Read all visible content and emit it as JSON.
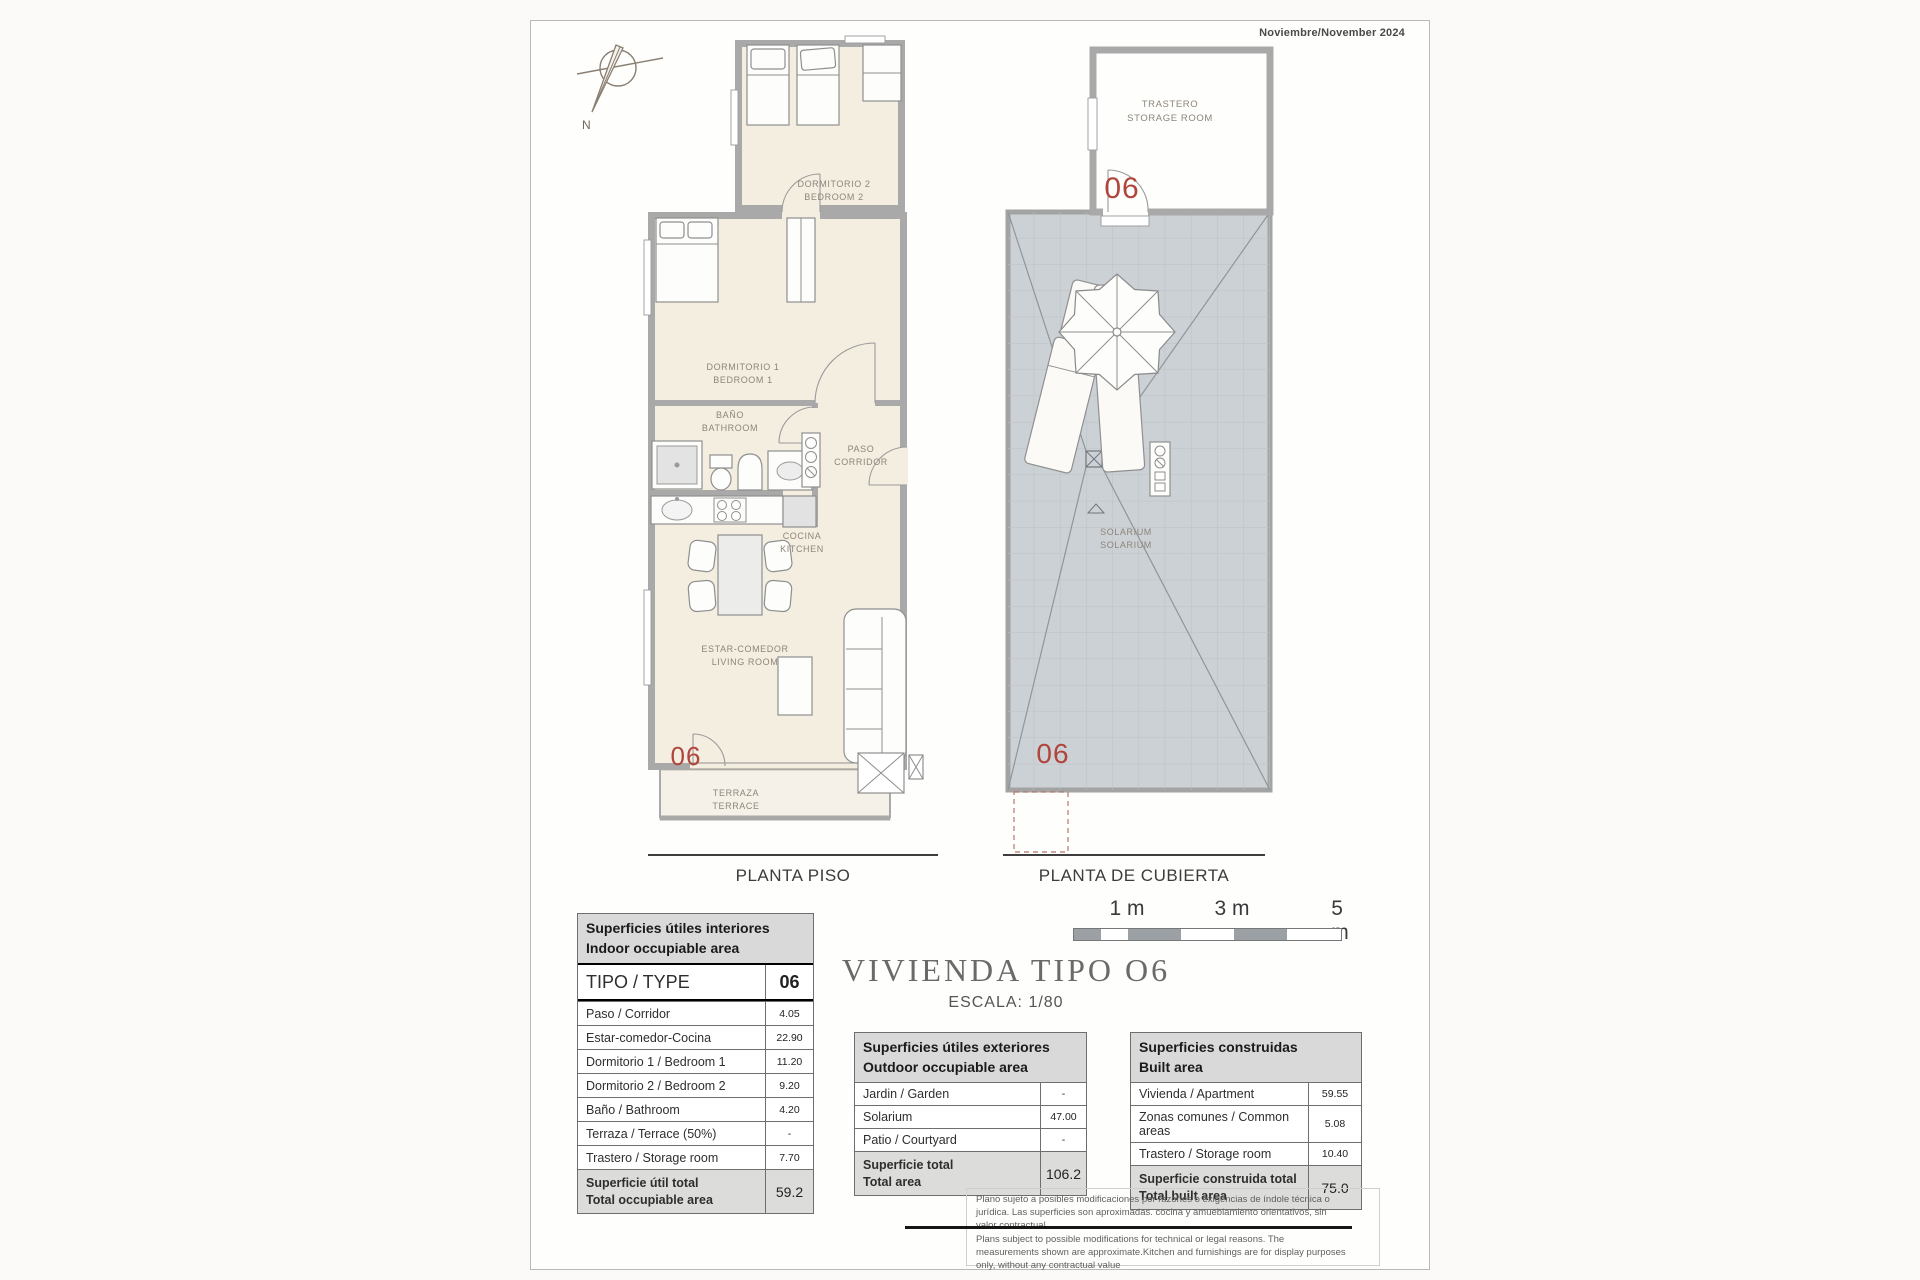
{
  "page": {
    "date": "Noviembre/November 2024"
  },
  "compass": {
    "north_label": "N"
  },
  "floor_plan": {
    "caption": "PLANTA PISO",
    "unit_number": "06",
    "rooms": {
      "bedroom2": {
        "es": "DORMITORIO 2",
        "en": "BEDROOM 2"
      },
      "bedroom1": {
        "es": "DORMITORIO 1",
        "en": "BEDROOM 1"
      },
      "bathroom": {
        "es": "BAÑO",
        "en": "BATHROOM"
      },
      "corridor": {
        "es": "PASO",
        "en": "CORRIDOR"
      },
      "kitchen": {
        "es": "COCINA",
        "en": "KITCHEN"
      },
      "living": {
        "es": "ESTAR-COMEDOR",
        "en": "LIVING ROOM"
      },
      "terrace": {
        "es": "TERRAZA",
        "en": "TERRACE"
      }
    }
  },
  "roof_plan": {
    "caption": "PLANTA DE CUBIERTA",
    "unit_number": "06",
    "rooms": {
      "storage": {
        "es": "TRASTERO",
        "en": "STORAGE ROOM"
      },
      "solarium": {
        "es": "SOLARIUM",
        "en": "SOLARIUM"
      }
    }
  },
  "title_block": {
    "title": "VIVIENDA TIPO O6",
    "scale": "ESCALA: 1/80"
  },
  "scale_bar": {
    "labels": [
      "1 m",
      "3 m",
      "5 m"
    ]
  },
  "tables": {
    "interior": {
      "header_es": "Superficies útiles interiores",
      "header_en": "Indoor occupiable area",
      "type_label": "TIPO / TYPE",
      "type_value": "06",
      "rows": [
        {
          "label": "Paso / Corridor",
          "value": "4.05"
        },
        {
          "label": "Estar-comedor-Cocina",
          "value": "22.90"
        },
        {
          "label": "Dormitorio 1 / Bedroom 1",
          "value": "11.20"
        },
        {
          "label": "Dormitorio 2 / Bedroom 2",
          "value": "9.20"
        },
        {
          "label": "Baño / Bathroom",
          "value": "4.20"
        },
        {
          "label": "Terraza / Terrace (50%)",
          "value": "-"
        },
        {
          "label": "Trastero / Storage room",
          "value": "7.70"
        }
      ],
      "total_label_es": "Superficie útil total",
      "total_label_en": "Total occupiable area",
      "total_value": "59.2"
    },
    "exterior": {
      "header_es": "Superficies útiles exteriores",
      "header_en": "Outdoor occupiable area",
      "rows": [
        {
          "label": "Jardin / Garden",
          "value": "-"
        },
        {
          "label": "Solarium",
          "value": "47.00"
        },
        {
          "label": "Patio / Courtyard",
          "value": "-"
        }
      ],
      "total_label_es": "Superficie total",
      "total_label_en": "Total area",
      "total_value": "106.2"
    },
    "built": {
      "header_es": "Superficies construidas",
      "header_en": "Built area",
      "rows": [
        {
          "label": "Vivienda / Apartment",
          "value": "59.55"
        },
        {
          "label": "Zonas comunes / Common areas",
          "value": "5.08"
        },
        {
          "label": "Trastero / Storage room",
          "value": "10.40"
        }
      ],
      "total_label_es": "Superficie construida total",
      "total_label_en": "Total built area",
      "total_value": "75.0"
    }
  },
  "disclaimer": {
    "es": "Plano sujeto a posibles modificaciones por razones o exigencias de índole técnica o jurídica. Las superficies son aproximadas. cocina y amueblamiento  orientativos, sin valor contractual",
    "en": "Plans subject to possible modifications for technical or legal reasons. The measurements shown are approximate.Kitchen and furnishings are for display purposes only, without any contractual value"
  }
}
